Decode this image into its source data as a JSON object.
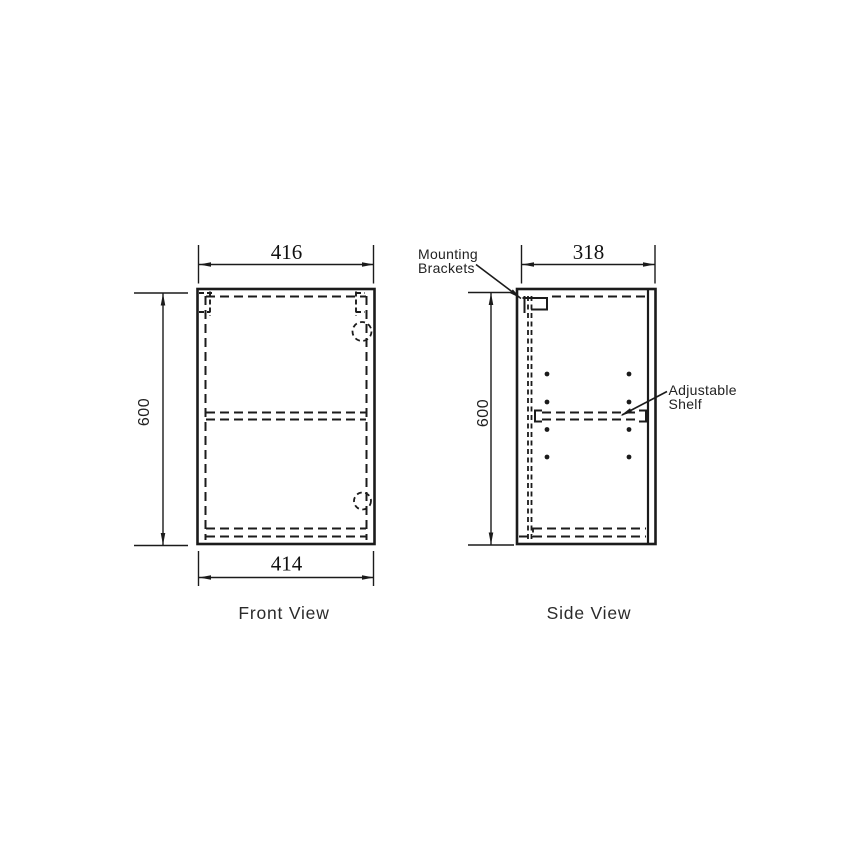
{
  "page": {
    "background": "#ffffff",
    "line_color": "#1b1b1b"
  },
  "front_view": {
    "label": "Front View",
    "dim_top_width": "416",
    "dim_bottom_width": "414",
    "dim_height": "600"
  },
  "side_view": {
    "label": "Side View",
    "dim_top_width": "318",
    "dim_height": "600"
  },
  "callouts": {
    "mounting_brackets_line1": "Mounting",
    "mounting_brackets_line2": "Brackets",
    "adjustable_shelf_line1": "Adjustable",
    "adjustable_shelf_line2": "Shelf"
  }
}
